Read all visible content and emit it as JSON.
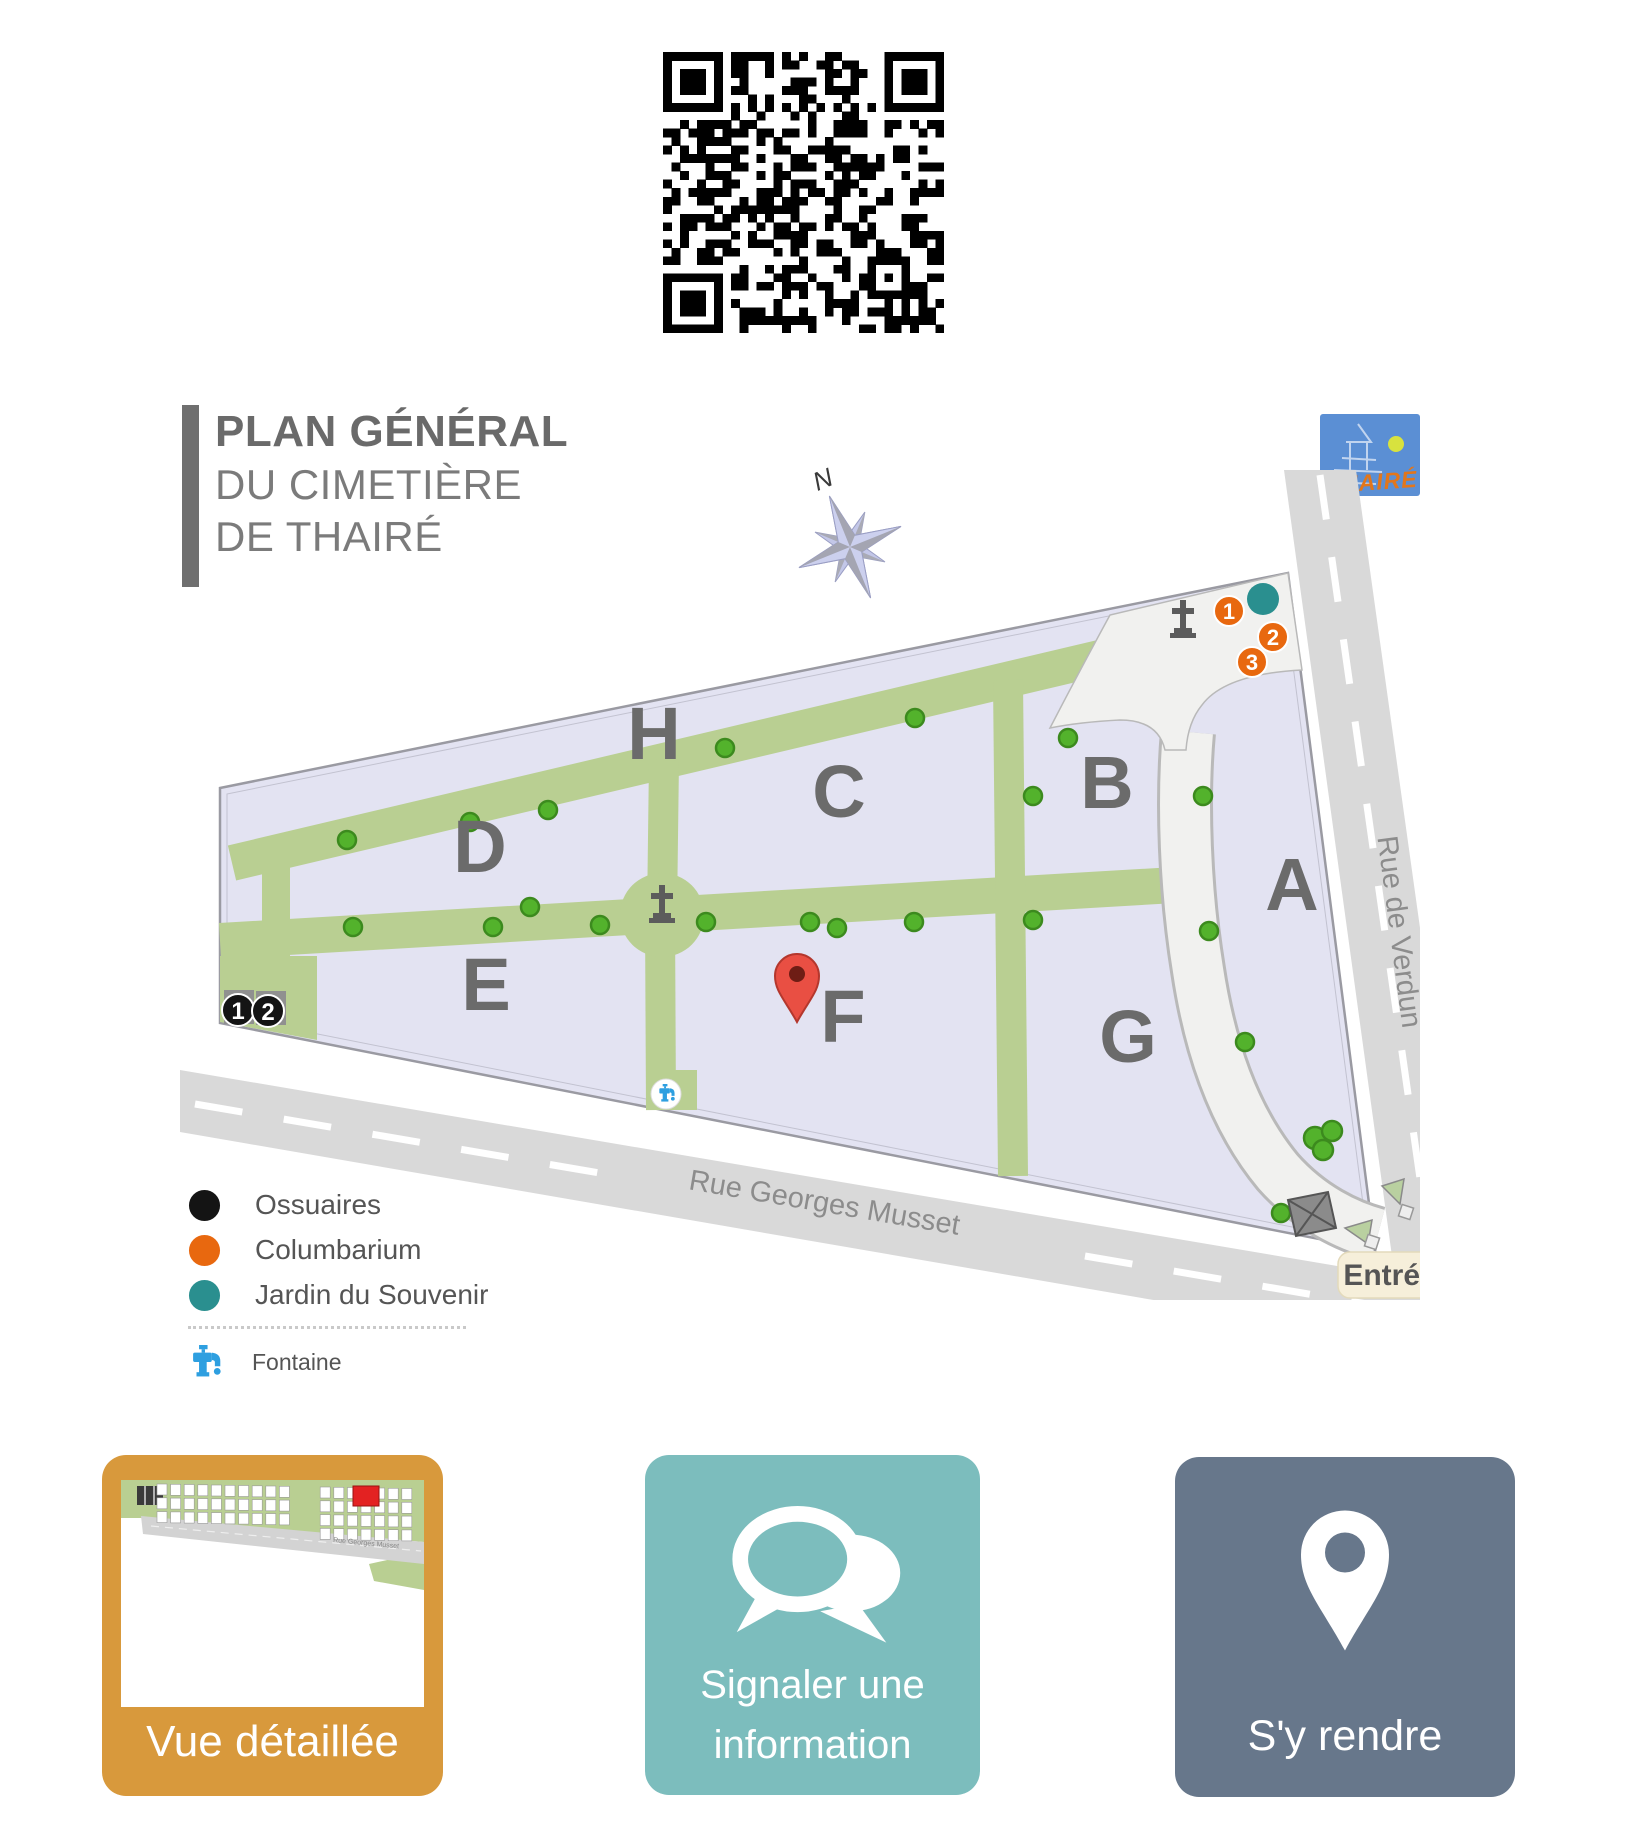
{
  "qr": {
    "modules": 33,
    "seed": 987613,
    "density": 0.47
  },
  "header": {
    "title_line1": "PLAN GÉNÉRAL",
    "title_line2": "DU CIMETIÈRE",
    "title_line3": "DE THAIRÉ"
  },
  "compass": {
    "north_label": "N"
  },
  "logo": {
    "name": "THAIRÉ"
  },
  "map": {
    "sections": {
      "a": "A",
      "b": "B",
      "c": "C",
      "d": "D",
      "e": "E",
      "f": "F",
      "g": "G",
      "h": "H"
    },
    "streets": {
      "verdun": "Rue de Verdun",
      "musset": "Rue Georges Musset"
    },
    "entrance_label": "Entrée",
    "markers": {
      "ossuaires": [
        "1",
        "2"
      ],
      "columbarium": [
        "1",
        "2",
        "3"
      ]
    },
    "colors": {
      "section_fill": "#e3e3f2",
      "path_green": "#b9cf92",
      "tree": "#53b22c",
      "tree_edge": "#3c8a1e",
      "road": "#d9d9d9",
      "white_path": "#f1f1ef",
      "ossuaire": "#141414",
      "columbarium": "#e8680f",
      "jardin": "#2a8f8f",
      "pin": "#e94f43"
    },
    "trees": [
      [
        167,
        370
      ],
      [
        290,
        352
      ],
      [
        368,
        340
      ],
      [
        545,
        278
      ],
      [
        735,
        248
      ],
      [
        888,
        268
      ],
      [
        350,
        437
      ],
      [
        173,
        457
      ],
      [
        313,
        457
      ],
      [
        420,
        455
      ],
      [
        526,
        452
      ],
      [
        630,
        452
      ],
      [
        657,
        458
      ],
      [
        734,
        452
      ],
      [
        853,
        450
      ],
      [
        853,
        326
      ],
      [
        1023,
        326
      ],
      [
        1029,
        461
      ],
      [
        1065,
        572
      ],
      [
        1135,
        668,
        11
      ],
      [
        1152,
        661,
        10
      ],
      [
        1143,
        680,
        10
      ],
      [
        1101,
        743
      ]
    ]
  },
  "legend": {
    "items": [
      {
        "label": "Ossuaires",
        "color": "#141414"
      },
      {
        "label": "Columbarium",
        "color": "#e8680f"
      },
      {
        "label": "Jardin du Souvenir",
        "color": "#2a8f8f"
      }
    ],
    "fountain": {
      "label": "Fontaine",
      "color": "#2e9fe0"
    }
  },
  "buttons": [
    {
      "label": "Vue détaillée",
      "color": "#d8993c",
      "icon": "mini-map"
    },
    {
      "label_line1": "Signaler une",
      "label_line2": "information",
      "color": "#7cbdbd",
      "icon": "chat"
    },
    {
      "label": "S'y rendre",
      "color": "#67778b",
      "icon": "pin"
    }
  ],
  "vue_thumb": {
    "street": "Rue Georges Musset"
  }
}
